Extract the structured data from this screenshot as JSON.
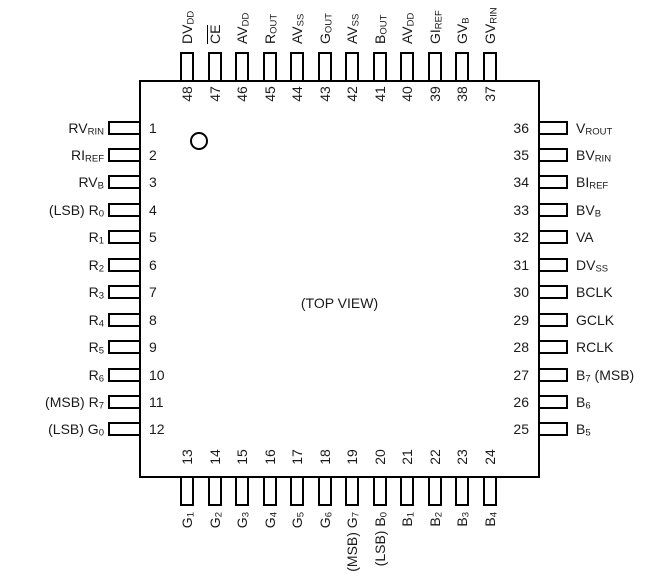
{
  "chip": {
    "package_center_label": "(TOP VIEW)",
    "colors": {
      "line": "#000000",
      "text": "#1a1a1a",
      "background": "#ffffff"
    },
    "pin1_indicator": "circle",
    "top_pins": [
      {
        "number": "48",
        "label": [
          {
            "t": "DV"
          },
          {
            "sub": "DD"
          }
        ]
      },
      {
        "number": "47",
        "label": [
          {
            "ov": "CE"
          }
        ]
      },
      {
        "number": "46",
        "label": [
          {
            "t": "AV"
          },
          {
            "sub": "DD"
          }
        ]
      },
      {
        "number": "45",
        "label": [
          {
            "t": "R"
          },
          {
            "sub": "OUT"
          }
        ]
      },
      {
        "number": "44",
        "label": [
          {
            "t": "AV"
          },
          {
            "sub": "SS"
          }
        ]
      },
      {
        "number": "43",
        "label": [
          {
            "t": "G"
          },
          {
            "sub": "OUT"
          }
        ]
      },
      {
        "number": "42",
        "label": [
          {
            "t": "AV"
          },
          {
            "sub": "SS"
          }
        ]
      },
      {
        "number": "41",
        "label": [
          {
            "t": "B"
          },
          {
            "sub": "OUT"
          }
        ]
      },
      {
        "number": "40",
        "label": [
          {
            "t": "AV"
          },
          {
            "sub": "DD"
          }
        ]
      },
      {
        "number": "39",
        "label": [
          {
            "t": "GI"
          },
          {
            "sub": "REF"
          }
        ]
      },
      {
        "number": "38",
        "label": [
          {
            "t": "GV"
          },
          {
            "sub": "B"
          }
        ]
      },
      {
        "number": "37",
        "label": [
          {
            "t": "GV"
          },
          {
            "sub": "RIN"
          }
        ]
      }
    ],
    "left_pins": [
      {
        "number": "1",
        "label": [
          {
            "t": "RV"
          },
          {
            "sub": "RIN"
          }
        ]
      },
      {
        "number": "2",
        "label": [
          {
            "t": "RI"
          },
          {
            "sub": "REF"
          }
        ]
      },
      {
        "number": "3",
        "label": [
          {
            "t": "RV"
          },
          {
            "sub": "B"
          }
        ]
      },
      {
        "number": "4",
        "label": [
          {
            "t": "(LSB) R"
          },
          {
            "sub": "0"
          }
        ]
      },
      {
        "number": "5",
        "label": [
          {
            "t": "R"
          },
          {
            "sub": "1"
          }
        ]
      },
      {
        "number": "6",
        "label": [
          {
            "t": "R"
          },
          {
            "sub": "2"
          }
        ]
      },
      {
        "number": "7",
        "label": [
          {
            "t": "R"
          },
          {
            "sub": "3"
          }
        ]
      },
      {
        "number": "8",
        "label": [
          {
            "t": "R"
          },
          {
            "sub": "4"
          }
        ]
      },
      {
        "number": "9",
        "label": [
          {
            "t": "R"
          },
          {
            "sub": "5"
          }
        ]
      },
      {
        "number": "10",
        "label": [
          {
            "t": "R"
          },
          {
            "sub": "6"
          }
        ]
      },
      {
        "number": "11",
        "label": [
          {
            "t": "(MSB) R"
          },
          {
            "sub": "7"
          }
        ]
      },
      {
        "number": "12",
        "label": [
          {
            "t": "(LSB) G"
          },
          {
            "sub": "0"
          }
        ]
      }
    ],
    "right_pins": [
      {
        "number": "36",
        "label": [
          {
            "t": "V"
          },
          {
            "sub": "ROUT"
          }
        ]
      },
      {
        "number": "35",
        "label": [
          {
            "t": "BV"
          },
          {
            "sub": "RIN"
          }
        ]
      },
      {
        "number": "34",
        "label": [
          {
            "t": "BI"
          },
          {
            "sub": "REF"
          }
        ]
      },
      {
        "number": "33",
        "label": [
          {
            "t": "BV"
          },
          {
            "sub": "B"
          }
        ]
      },
      {
        "number": "32",
        "label": [
          {
            "t": "VA"
          }
        ]
      },
      {
        "number": "31",
        "label": [
          {
            "t": "DV"
          },
          {
            "sub": "SS"
          }
        ]
      },
      {
        "number": "30",
        "label": [
          {
            "t": "BCLK"
          }
        ]
      },
      {
        "number": "29",
        "label": [
          {
            "t": "GCLK"
          }
        ]
      },
      {
        "number": "28",
        "label": [
          {
            "t": "RCLK"
          }
        ]
      },
      {
        "number": "27",
        "label": [
          {
            "t": "B"
          },
          {
            "sub": "7"
          },
          {
            "t": " (MSB)"
          }
        ]
      },
      {
        "number": "26",
        "label": [
          {
            "t": "B"
          },
          {
            "sub": "6"
          }
        ]
      },
      {
        "number": "25",
        "label": [
          {
            "t": "B"
          },
          {
            "sub": "5"
          }
        ]
      }
    ],
    "bottom_pins": [
      {
        "number": "13",
        "label": [
          {
            "t": "G"
          },
          {
            "sub": "1"
          }
        ]
      },
      {
        "number": "14",
        "label": [
          {
            "t": "G"
          },
          {
            "sub": "2"
          }
        ]
      },
      {
        "number": "15",
        "label": [
          {
            "t": "G"
          },
          {
            "sub": "3"
          }
        ]
      },
      {
        "number": "16",
        "label": [
          {
            "t": "G"
          },
          {
            "sub": "4"
          }
        ]
      },
      {
        "number": "17",
        "label": [
          {
            "t": "G"
          },
          {
            "sub": "5"
          }
        ]
      },
      {
        "number": "18",
        "label": [
          {
            "t": "G"
          },
          {
            "sub": "6"
          }
        ]
      },
      {
        "number": "19",
        "label": [
          {
            "t": "(MSB) G"
          },
          {
            "sub": "7"
          }
        ]
      },
      {
        "number": "20",
        "label": [
          {
            "t": "(LSB) B"
          },
          {
            "sub": "0"
          }
        ]
      },
      {
        "number": "21",
        "label": [
          {
            "t": "B"
          },
          {
            "sub": "1"
          }
        ]
      },
      {
        "number": "22",
        "label": [
          {
            "t": "B"
          },
          {
            "sub": "2"
          }
        ]
      },
      {
        "number": "23",
        "label": [
          {
            "t": "B"
          },
          {
            "sub": "3"
          }
        ]
      },
      {
        "number": "24",
        "label": [
          {
            "t": "B"
          },
          {
            "sub": "4"
          }
        ]
      }
    ]
  }
}
